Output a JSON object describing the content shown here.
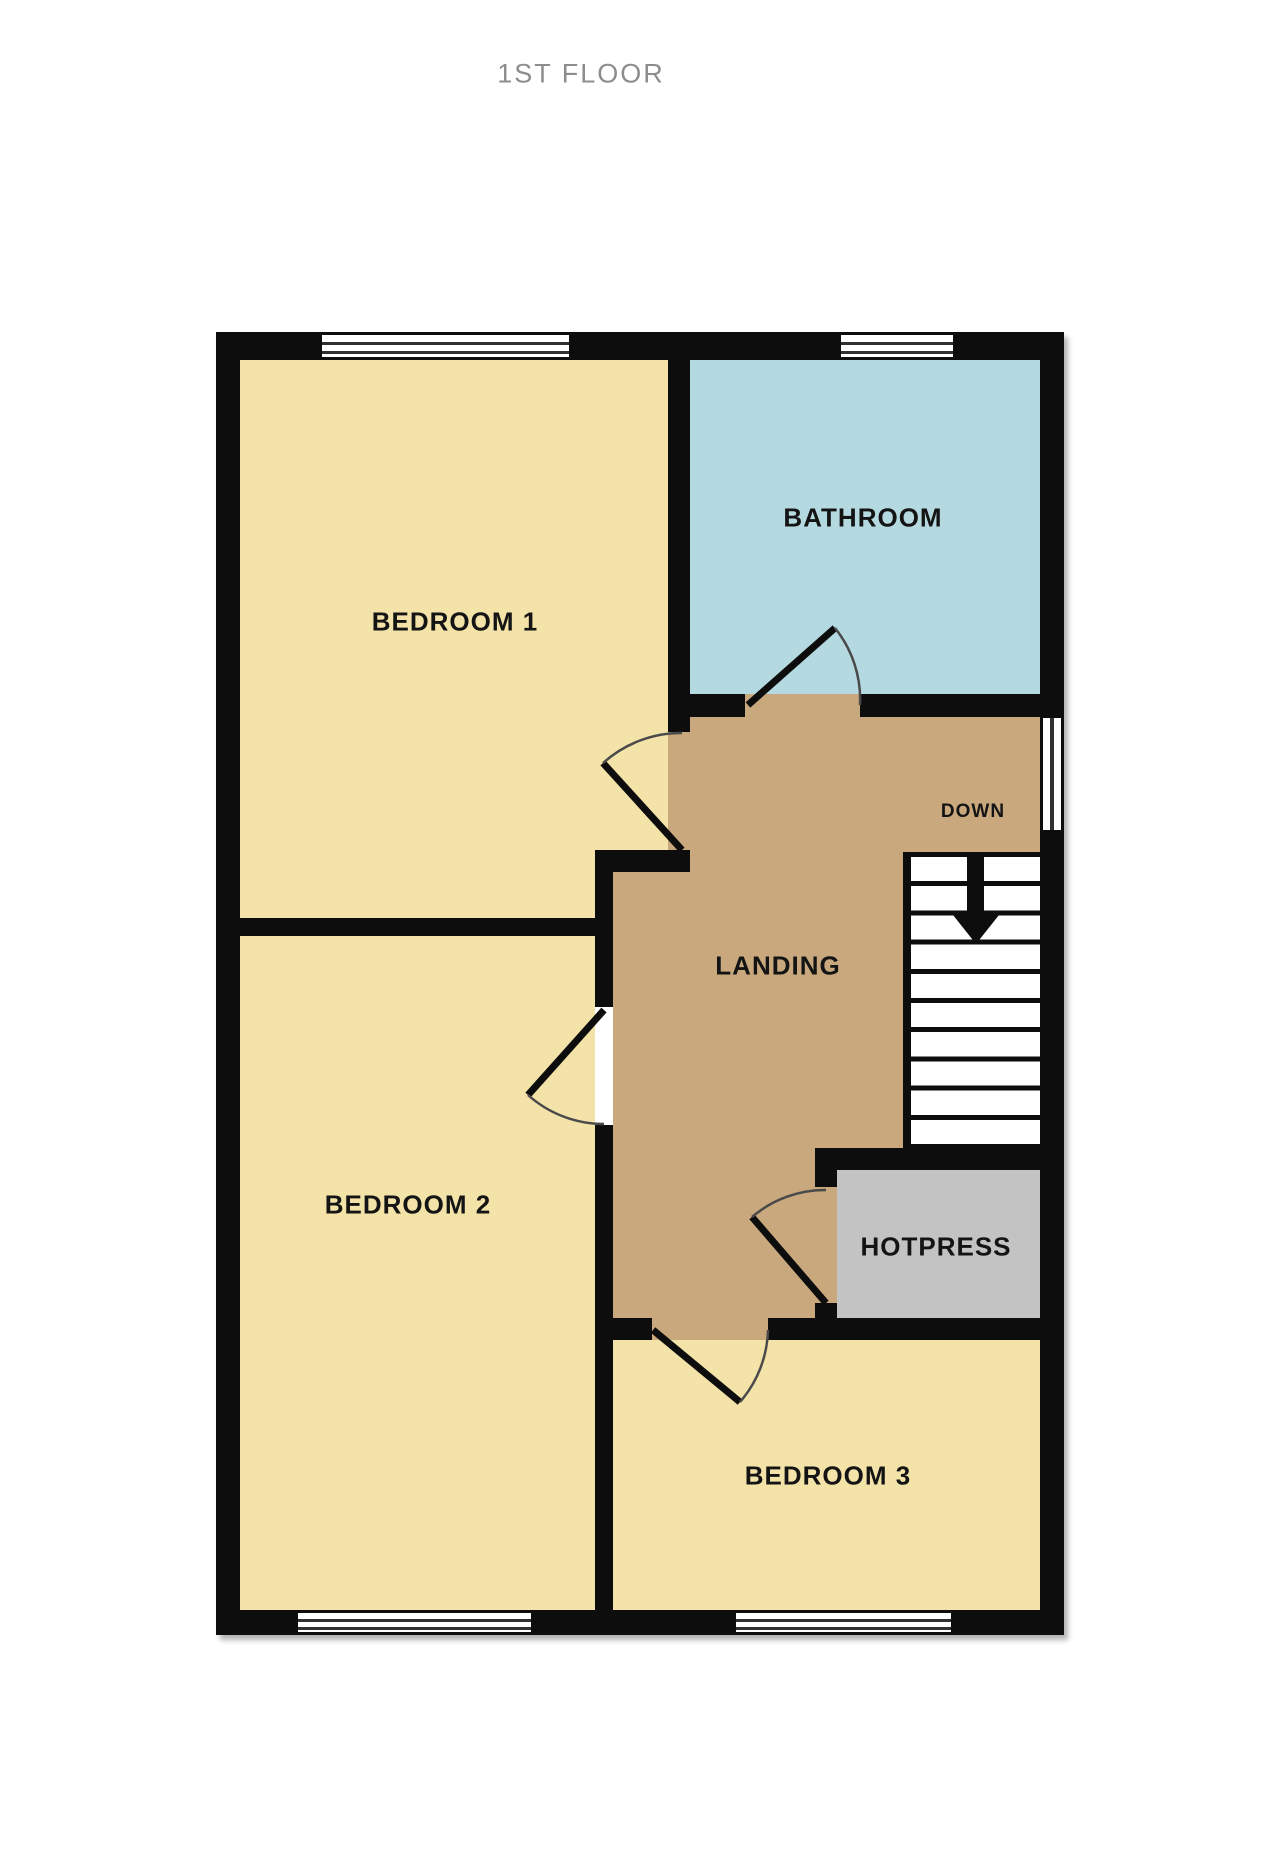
{
  "title": "1ST FLOOR",
  "rooms": {
    "bedroom1": {
      "label": "BEDROOM 1"
    },
    "bathroom": {
      "label": "BATHROOM"
    },
    "landing": {
      "label": "LANDING"
    },
    "bedroom2": {
      "label": "BEDROOM 2"
    },
    "hotpress": {
      "label": "HOTPRESS"
    },
    "bedroom3": {
      "label": "BEDROOM 3"
    }
  },
  "stairs": {
    "label": "DOWN",
    "direction": "down",
    "steps": 10
  },
  "colors": {
    "wall": "#0d0d0d",
    "bedroom": "#f3e3a9",
    "landing": "#c9a87d",
    "bathroom": "#b5d9e0",
    "hotpress": "#c3c3c3",
    "stairs": "#ffffff",
    "label": "#141414",
    "title": "#8d8d8d",
    "door-arc": "#4a4a4a"
  }
}
